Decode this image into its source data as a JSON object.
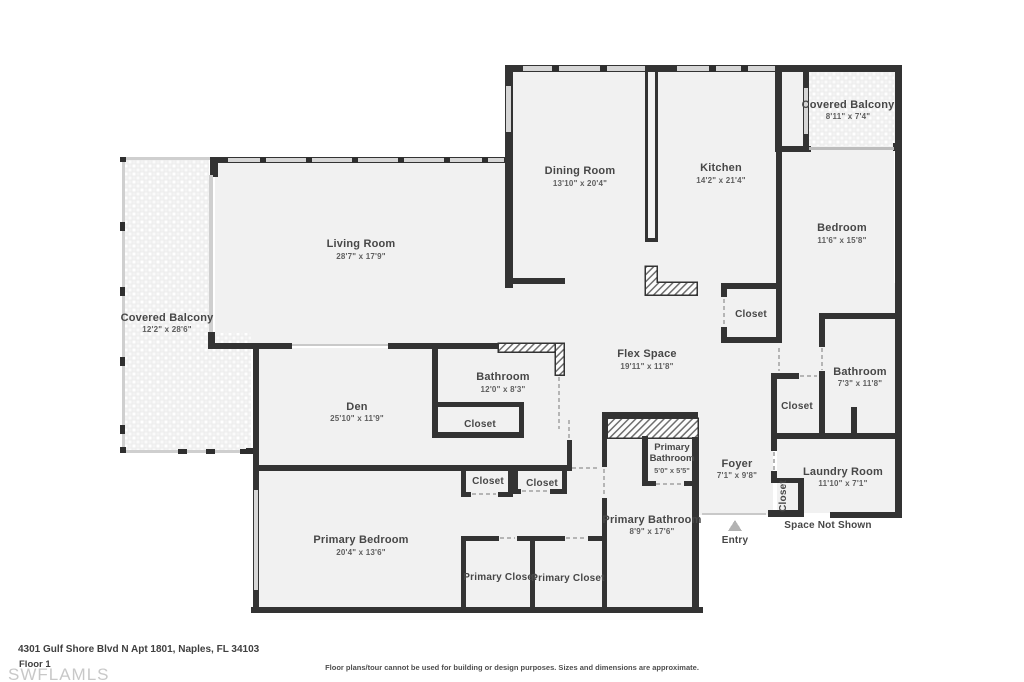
{
  "palette": {
    "background": "#ffffff",
    "wall": "#333333",
    "floor": "#f1f1f1",
    "balcony_texture": "#ececec",
    "window": "#d6d6d6",
    "door_dash": "#b5b5b5",
    "room_text": "#474747",
    "dim_text": "#5f5f5f",
    "watermark": "#c8c8c8",
    "entry_arrow": "#b3b3b3"
  },
  "rooms": {
    "dining": {
      "name": "Dining Room",
      "dims": "13'10\" x 20'4\""
    },
    "kitchen": {
      "name": "Kitchen",
      "dims": "14'2\" x 21'4\""
    },
    "balcony_right": {
      "name": "Covered Balcony",
      "dims": "8'11\" x 7'4\""
    },
    "bedroom": {
      "name": "Bedroom",
      "dims": "11'6\" x 15'8\""
    },
    "living": {
      "name": "Living Room",
      "dims": "28'7\" x 17'9\""
    },
    "balcony_left": {
      "name": "Covered Balcony",
      "dims": "12'2\" x 28'6\""
    },
    "flex": {
      "name": "Flex Space",
      "dims": "19'11\" x 11'8\""
    },
    "bathroom_right": {
      "name": "Bathroom",
      "dims": "7'3\" x 11'8\""
    },
    "bathroom_center": {
      "name": "Bathroom",
      "dims": "12'0\" x 8'3\""
    },
    "den": {
      "name": "Den",
      "dims": "25'10\" x 11'9\""
    },
    "primary_bath_small": {
      "name_line1": "Primary",
      "name_line2": "Bathroom",
      "dims": "5'0\" x 5'5\""
    },
    "foyer": {
      "name": "Foyer",
      "dims": "7'1\" x 9'8\""
    },
    "laundry": {
      "name": "Laundry Room",
      "dims": "11'10\" x 7'1\""
    },
    "primary_bathroom": {
      "name": "Primary Bathroom",
      "dims": "8'9\" x 17'6\""
    },
    "primary_bedroom": {
      "name": "Primary Bedroom",
      "dims": "20'4\" x 13'6\""
    }
  },
  "labels": {
    "closet": "Closet",
    "primary_closet": "Primary Closet",
    "entry": "Entry",
    "space_not_shown": "Space Not Shown"
  },
  "footer": {
    "address": "4301 Gulf Shore Blvd N Apt 1801, Naples, FL 34103",
    "floor": "Floor 1",
    "watermark": "SWFLAMLS",
    "disclaimer": "Floor plans/tour cannot be used for building or design purposes. Sizes and dimensions are approximate."
  }
}
